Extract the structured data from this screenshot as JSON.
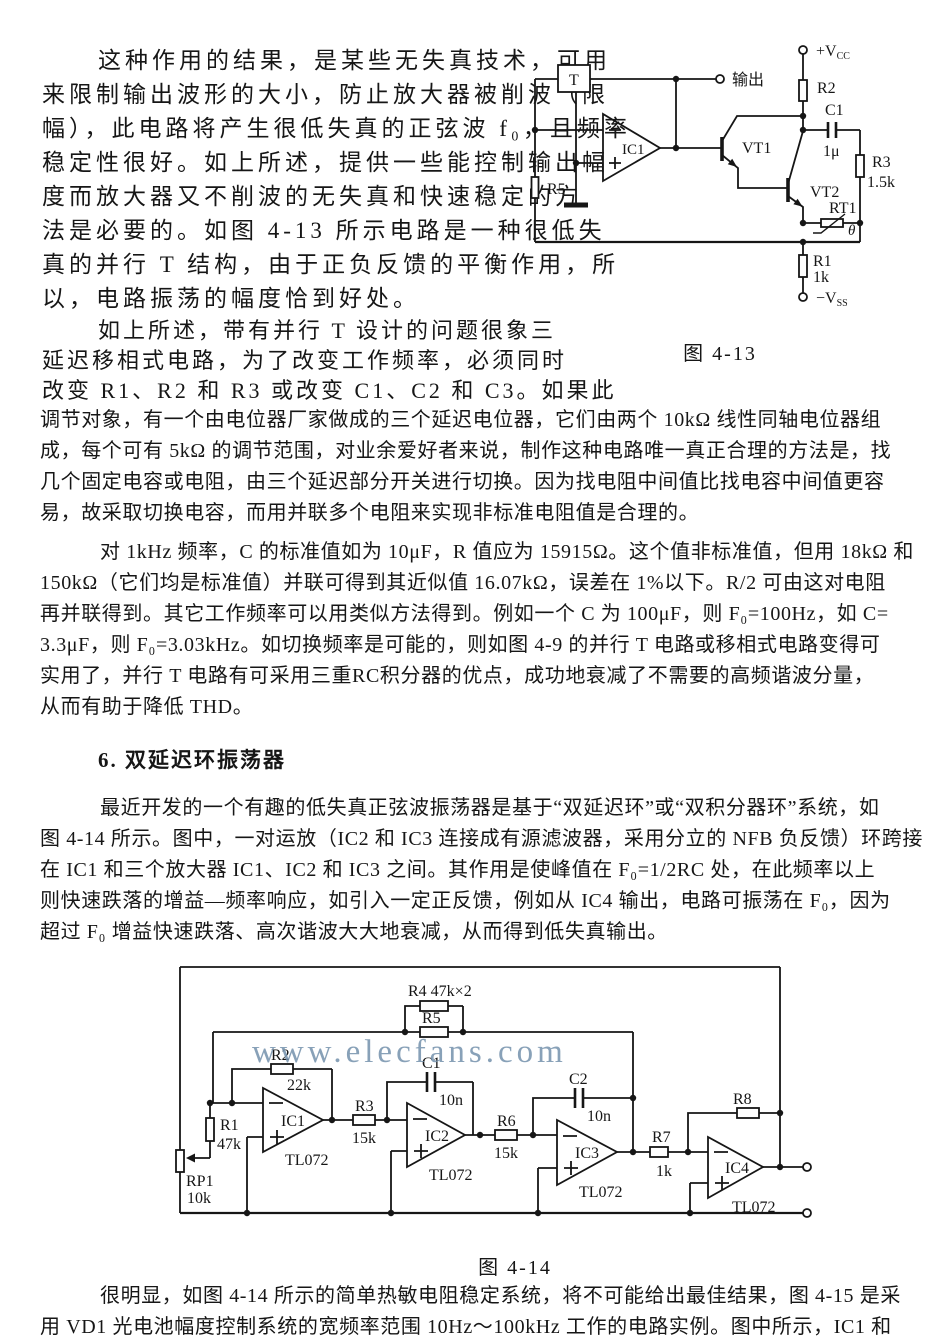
{
  "text": {
    "p1": [
      "这种作用的结果，是某些无失真技术，可用",
      "来限制输出波形的大小，防止放大器被削波（限",
      "幅），此电路将产生很低失真的正弦波 f₀，且频率",
      "稳定性很好。如上所述，提供一些能控制输出幅",
      "度而放大器又不削波的无失真和快速稳定的方",
      "法是必要的。如图 4-13 所示电路是一种很低失",
      "真的并行 T 结构，由于正负反馈的平衡作用，所",
      "以，电路振荡的幅度恰到好处。"
    ],
    "p2a": [
      "如上所述，带有并行 T 设计的问题很象三",
      "延迟移相式电路，为了改变工作频率，必须同时",
      "改变 R1、R2 和 R3 或改变 C1、C2 和 C3。如果此"
    ],
    "p2b": [
      "调节对象，有一个由电位器厂家做成的三个延迟电位器，它们由两个 10kΩ 线性同轴电位器组",
      "成，每个可有 5kΩ 的调节范围，对业余爱好者来说，制作这种电路唯一真正合理的方法是，找",
      "几个固定电容或电阻，由三个延迟部分开关进行切换。因为找电阻中间值比找电容中间值更容",
      "易，故采取切换电容，而用并联多个电阻来实现非标准电阻值是合理的。"
    ],
    "p3": [
      "对 1kHz 频率，C 的标准值如为 10μF，R 值应为 15915Ω。这个值非标准值，但用 18kΩ 和",
      "150kΩ（它们均是标准值）并联可得到其近似值 16.07kΩ，误差在 1%以下。R/2 可由这对电阻",
      "再并联得到。其它工作频率可以用类似方法得到。例如一个 C 为 100μF，则 F₀=100Hz，如 C=",
      "3.3μF，则 F₀=3.03kHz。如切换频率是可能的，则如图 4-9 的并行 T 电路或移相式电路变得可",
      "实用了，并行 T 电路有可采用三重RC积分器的优点，成功地衰减了不需要的高频谐波分量，",
      "从而有助于降低 THD。"
    ],
    "heading": "6. 双延迟环振荡器",
    "p4": [
      "最近开发的一个有趣的低失真正弦波振荡器是基于“双延迟环”或“双积分器环”系统，如",
      "图 4-14 所示。图中，一对运放（IC2 和 IC3 连接成有源滤波器，采用分立的 NFB 负反馈）环跨接",
      "在 IC1 和三个放大器 IC1、IC2 和 IC3 之间。其作用是使峰值在 F₀=1/2RC 处，在此频率以上",
      "则快速跌落的增益—频率响应，如引入一定正反馈，例如从 IC4 输出，电路可振荡在 F₀，因为",
      "超过 F₀ 增益快速跌落、高次谐波大大地衰减，从而得到低失真输出。"
    ],
    "p5": [
      "很明显，如图 4-14 所示的简单热敏电阻稳定系统，将不可能给出最佳结果，图 4-15 是采",
      "用 VD1 光电池幅度控制系统的宽频率范围 10Hz～100kHz 工作的电路实例。图中所示，IC1 和"
    ]
  },
  "fig13": {
    "caption": "图 4-13",
    "labels": {
      "t": "T",
      "output": "输出",
      "ic1": "IC1",
      "vt1": "VT1",
      "vt2": "VT2",
      "vcc": "+V",
      "vcc_sub": "CC",
      "vss": "−V",
      "vss_sub": "SS",
      "r2": "R2",
      "c1": "C1",
      "c1_val": "1μ",
      "r3": "R3",
      "r3_val": "1.5k",
      "r5": "R5",
      "rt1": "RT1",
      "theta": "θ",
      "r1": "R1",
      "r1_val": "1k"
    }
  },
  "fig14": {
    "caption": "图 4-14",
    "watermark": "www.elecfans.com",
    "labels": {
      "r4": "R4 47k×2",
      "r5": "R5",
      "r2": "R2",
      "r2_val": "22k",
      "r1": "R1",
      "r1_val": "47k",
      "rp1": "RP1",
      "rp1_val": "10k",
      "r3": "R3",
      "r3_val": "15k",
      "c1": "C1",
      "c1_val": "10n",
      "r6": "R6",
      "r6_val": "15k",
      "c2": "C2",
      "c2_val": "10n",
      "r7": "R7",
      "r7_val": "1k",
      "r8": "R8",
      "ic1": "IC1",
      "ic2": "IC2",
      "ic3": "IC3",
      "ic4": "IC4",
      "tl072": "TL072"
    }
  }
}
